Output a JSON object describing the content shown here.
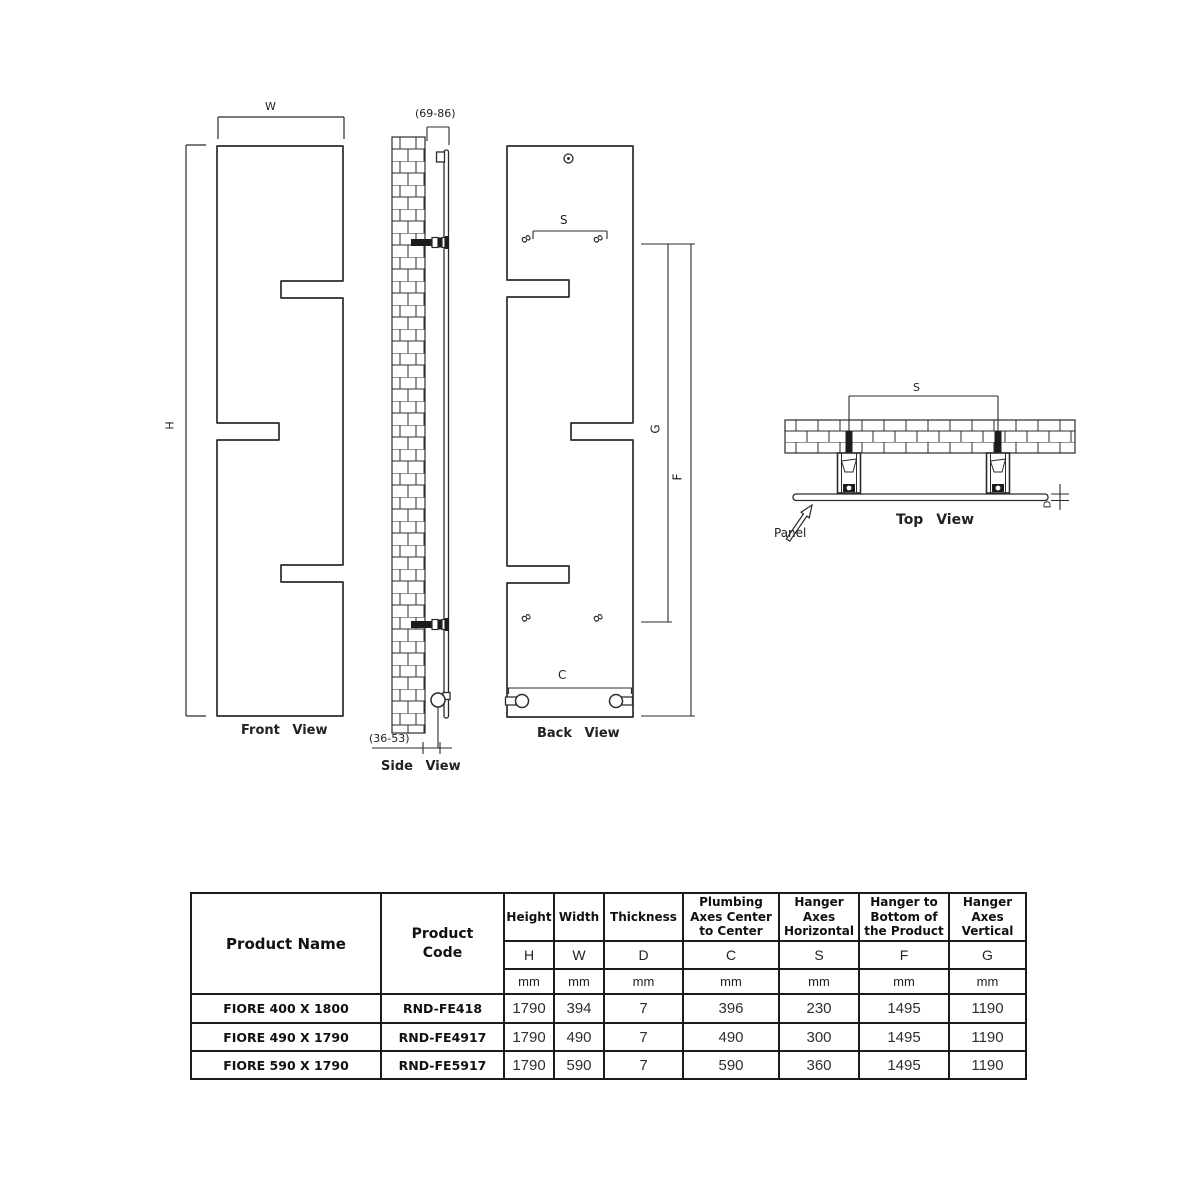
{
  "drawing": {
    "front_view": {
      "label": "Front View",
      "dim_width": "W",
      "dim_height": "H"
    },
    "side_view": {
      "label": "Side View",
      "dim_top": "(69-86)",
      "dim_bottom": "(36-53)"
    },
    "back_view": {
      "label": "Back View",
      "dim_s": "S",
      "dim_c": "C",
      "dim_g": "G",
      "dim_f": "F",
      "hanger_symbol": "8"
    },
    "top_view": {
      "label": "Top View",
      "dim_s": "S",
      "dim_d": "D",
      "panel_label": "Panel"
    }
  },
  "colors": {
    "line": "#2b2b2b",
    "text": "#1a1a1a"
  },
  "table": {
    "header": {
      "product_name": "Product Name",
      "product_code": "Product\nCode",
      "cols": [
        {
          "name": "Height",
          "letter": "H",
          "unit": "mm"
        },
        {
          "name": "Width",
          "letter": "W",
          "unit": "mm"
        },
        {
          "name": "Thickness",
          "letter": "D",
          "unit": "mm"
        },
        {
          "name": "Plumbing\nAxes Center\nto Center",
          "letter": "C",
          "unit": "mm"
        },
        {
          "name": "Hanger\nAxes\nHorizontal",
          "letter": "S",
          "unit": "mm"
        },
        {
          "name": "Hanger to\nBottom of\nthe Product",
          "letter": "F",
          "unit": "mm"
        },
        {
          "name": "Hanger\nAxes\nVertical",
          "letter": "G",
          "unit": "mm"
        }
      ]
    },
    "rows": [
      {
        "name": "FIORE 400 X 1800",
        "code": "RND-FE418",
        "values": [
          "1790",
          "394",
          "7",
          "396",
          "230",
          "1495",
          "1190"
        ]
      },
      {
        "name": "FIORE 490 X 1790",
        "code": "RND-FE4917",
        "values": [
          "1790",
          "490",
          "7",
          "490",
          "300",
          "1495",
          "1190"
        ]
      },
      {
        "name": "FIORE 590 X 1790",
        "code": "RND-FE5917",
        "values": [
          "1790",
          "590",
          "7",
          "590",
          "360",
          "1495",
          "1190"
        ]
      }
    ]
  }
}
